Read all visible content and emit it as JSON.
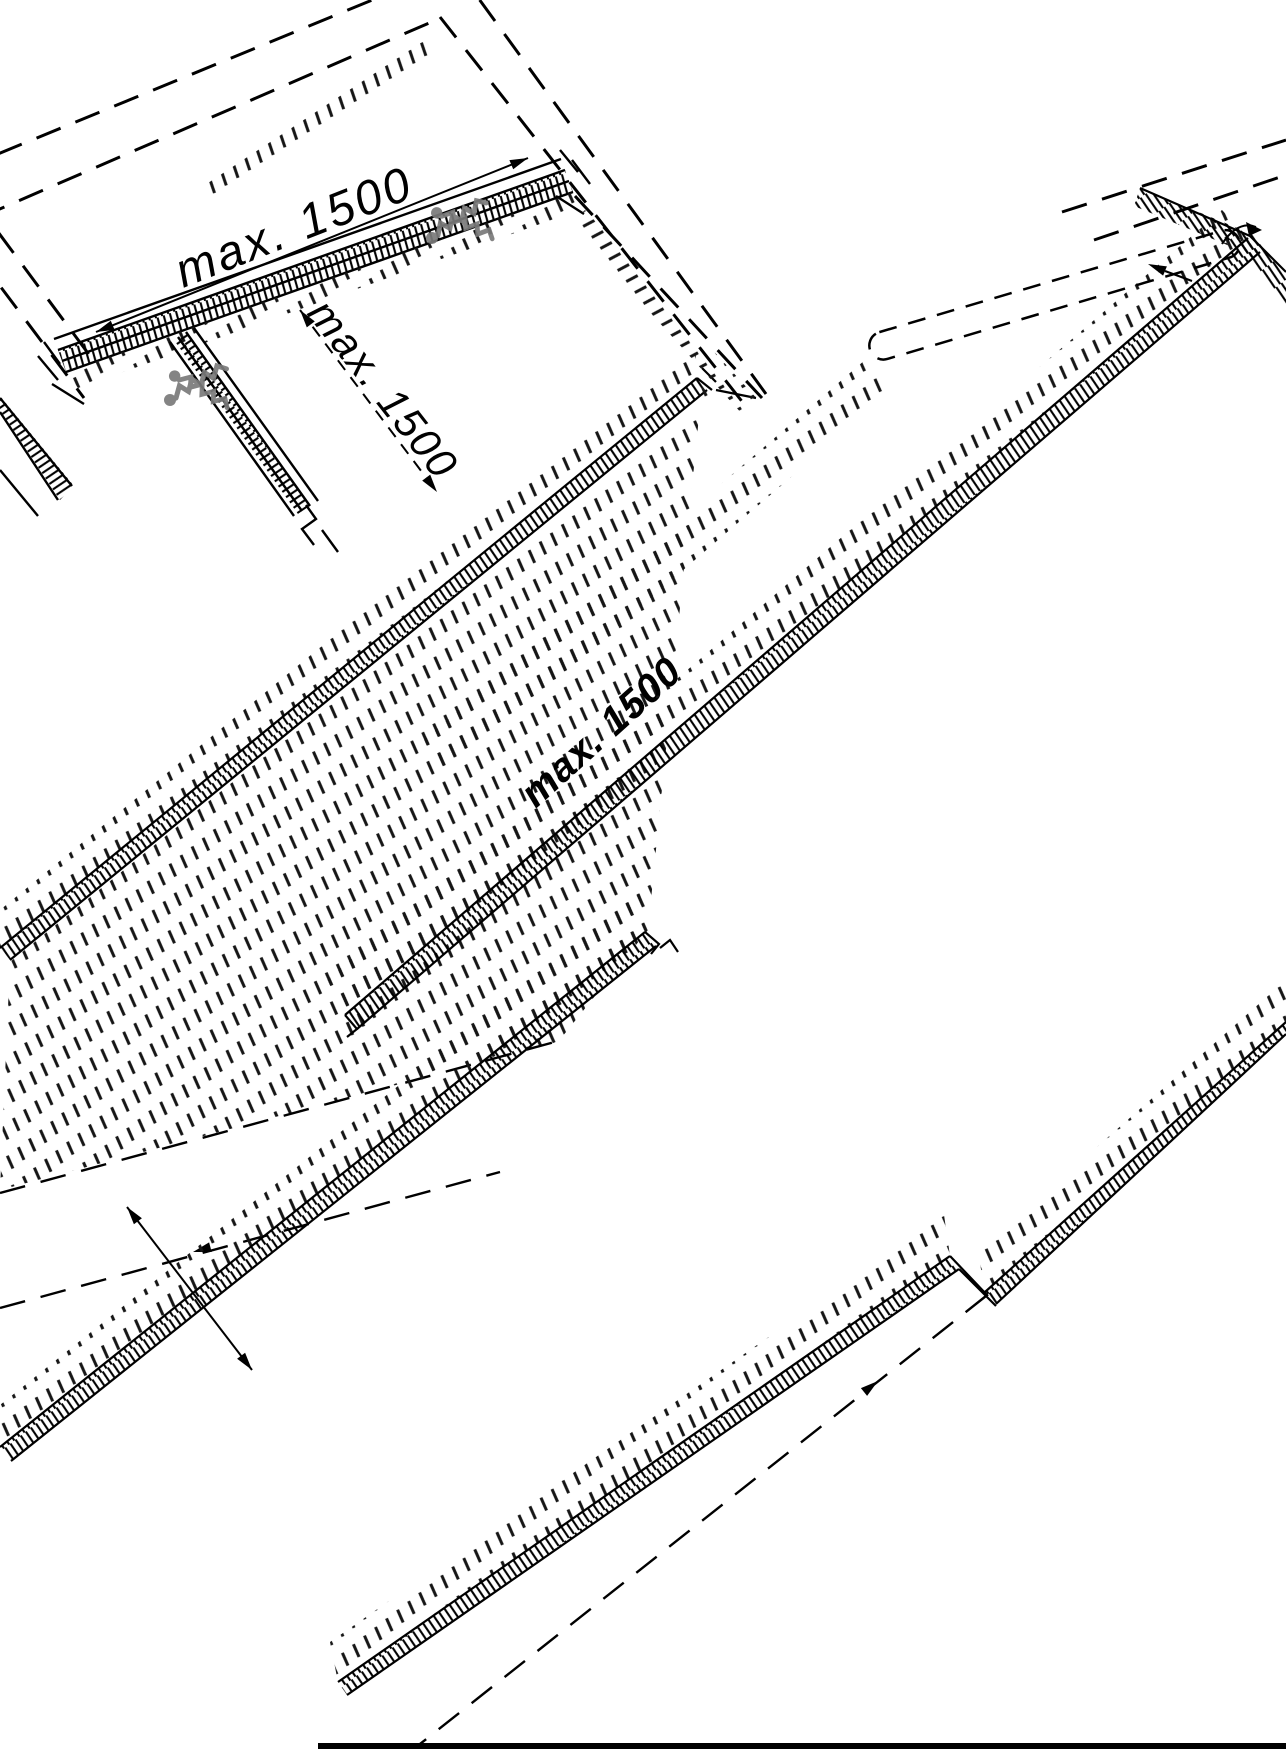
{
  "diagram": {
    "dimension_labels": {
      "ridge": {
        "text": "max. 1500"
      },
      "slope": {
        "text": "max. 1500"
      },
      "panel": {
        "text": "max. 1500"
      }
    },
    "icons": [
      {
        "name": "screws-icon",
        "color": "#7a7a7a"
      },
      {
        "name": "screws-icon",
        "color": "#7a7a7a"
      }
    ],
    "colors": {
      "line": "#000000",
      "background": "#ffffff",
      "screw": "#7a7a7a"
    }
  }
}
